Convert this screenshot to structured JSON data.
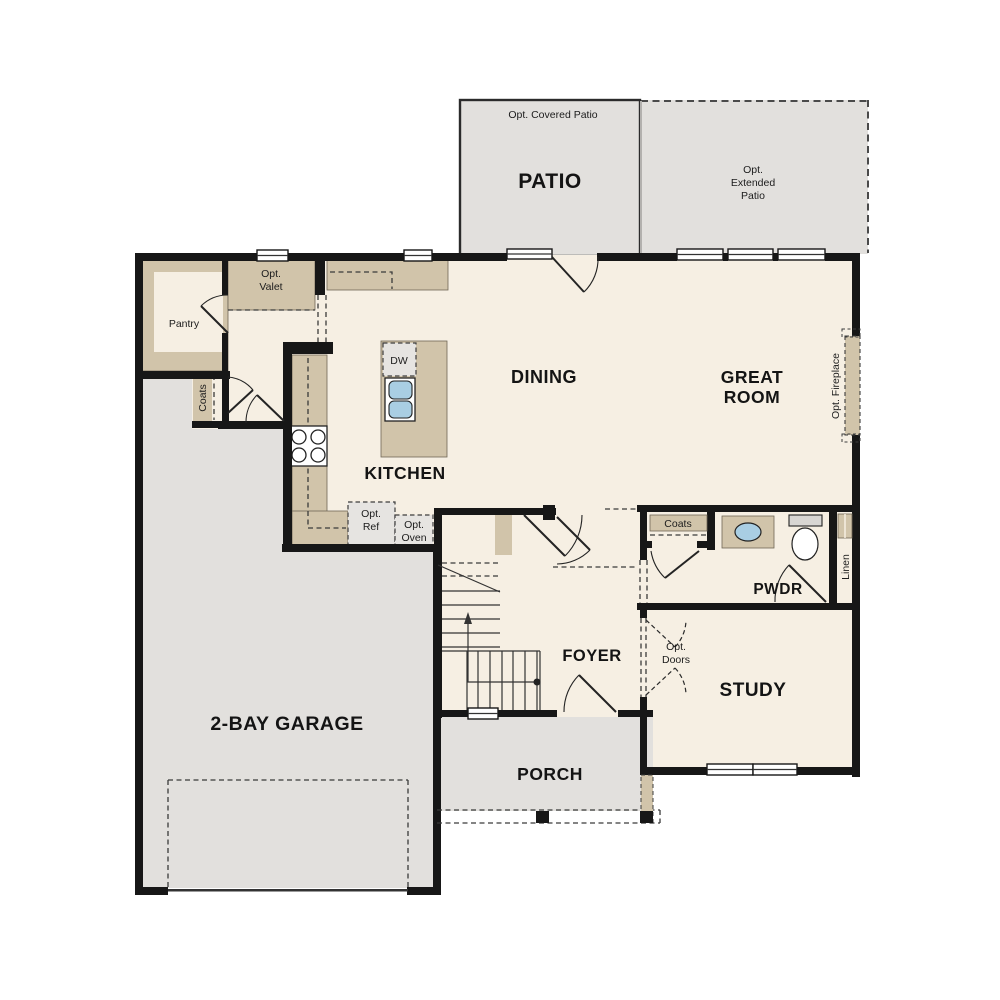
{
  "title": "Single-story floor plan, first floor",
  "colors": {
    "cream": "#f6efe3",
    "gray": "#e2e0dd",
    "tan": "#d1c4aa",
    "sink_blue": "#a9cee3",
    "wall": "#171717"
  },
  "rooms": {
    "patio": "PATIO",
    "dining": "DINING",
    "great_room_line1": "GREAT",
    "great_room_line2": "ROOM",
    "kitchen": "KITCHEN",
    "foyer": "FOYER",
    "study": "STUDY",
    "pwdr": "PWDR",
    "porch": "PORCH",
    "garage": "2-BAY GARAGE"
  },
  "annotations": {
    "opt_covered_patio": "Opt. Covered Patio",
    "opt_extended_patio": [
      "Opt.",
      "Extended",
      "Patio"
    ],
    "pantry": "Pantry",
    "opt_valet": [
      "Opt.",
      "Valet"
    ],
    "coats_left": "Coats",
    "coats_hall": "Coats",
    "linen": "Linen",
    "opt_fireplace": "Opt. Fireplace",
    "dw": "DW",
    "opt_ref": [
      "Opt.",
      "Ref"
    ],
    "opt_oven": [
      "Opt.",
      "Oven"
    ],
    "opt_doors": [
      "Opt.",
      "Doors"
    ]
  }
}
